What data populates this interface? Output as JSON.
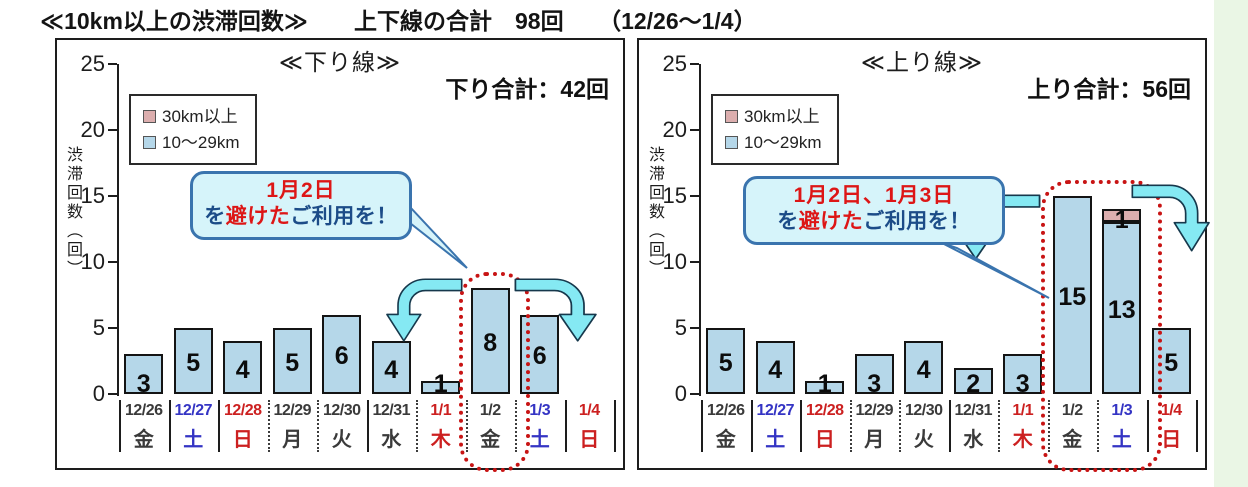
{
  "title": "≪10km以上の渋滞回数≫　　上下線の合計　98回　　（12/26～1/4）",
  "legend": {
    "items": [
      {
        "label": "30km以上",
        "color": "#dcaeae"
      },
      {
        "label": "10～29km",
        "color": "#b5d7e9"
      }
    ]
  },
  "y_axis": {
    "title": "渋滞回数（回）",
    "ticks": [
      25,
      20,
      15,
      10,
      5,
      0
    ]
  },
  "charts": [
    {
      "heading": "≪下り線≫",
      "total_label": "下り合計：42回",
      "callout": {
        "line1": "1月2日",
        "line2": [
          {
            "text": "を",
            "red": false
          },
          {
            "text": "避けた",
            "red": true
          },
          {
            "text": "ご利用を！",
            "red": false
          }
        ]
      },
      "highlight_days": [
        "1/2"
      ],
      "days": [
        {
          "date": "12/26",
          "weekday": "金",
          "color": "#3a3a3a",
          "sep": "solid"
        },
        {
          "date": "12/27",
          "weekday": "土",
          "color": "#3434c4",
          "sep": "solid"
        },
        {
          "date": "12/28",
          "weekday": "日",
          "color": "#cc2020",
          "sep": "solid"
        },
        {
          "date": "12/29",
          "weekday": "月",
          "color": "#3a3a3a",
          "sep": "dotted"
        },
        {
          "date": "12/30",
          "weekday": "火",
          "color": "#3a3a3a",
          "sep": "dotted"
        },
        {
          "date": "12/31",
          "weekday": "水",
          "color": "#3a3a3a",
          "sep": "solid"
        },
        {
          "date": "1/1",
          "weekday": "木",
          "color": "#cc2020",
          "sep": "dotted"
        },
        {
          "date": "1/2",
          "weekday": "金",
          "color": "#3a3a3a",
          "sep": "dotted"
        },
        {
          "date": "1/3",
          "weekday": "土",
          "color": "#3434c4",
          "sep": "dotted"
        },
        {
          "date": "1/4",
          "weekday": "日",
          "color": "#cc2020",
          "sep": "solid"
        }
      ]
    },
    {
      "heading": "≪上り線≫",
      "total_label": "上り合計：56回",
      "callout": {
        "line1": "1月2日、1月3日",
        "line2": [
          {
            "text": "を",
            "red": false
          },
          {
            "text": "避けた",
            "red": true
          },
          {
            "text": "ご利用を！",
            "red": false
          }
        ]
      },
      "highlight_days": [
        "1/2",
        "1/3"
      ],
      "days": [
        {
          "date": "12/26",
          "weekday": "金",
          "color": "#3a3a3a",
          "sep": "solid"
        },
        {
          "date": "12/27",
          "weekday": "土",
          "color": "#3434c4",
          "sep": "solid"
        },
        {
          "date": "12/28",
          "weekday": "日",
          "color": "#cc2020",
          "sep": "solid"
        },
        {
          "date": "12/29",
          "weekday": "月",
          "color": "#3a3a3a",
          "sep": "dotted"
        },
        {
          "date": "12/30",
          "weekday": "火",
          "color": "#3a3a3a",
          "sep": "dotted"
        },
        {
          "date": "12/31",
          "weekday": "水",
          "color": "#3a3a3a",
          "sep": "solid"
        },
        {
          "date": "1/1",
          "weekday": "木",
          "color": "#cc2020",
          "sep": "dotted"
        },
        {
          "date": "1/2",
          "weekday": "金",
          "color": "#3a3a3a",
          "sep": "dotted"
        },
        {
          "date": "1/3",
          "weekday": "土",
          "color": "#3434c4",
          "sep": "dotted"
        },
        {
          "date": "1/4",
          "weekday": "日",
          "color": "#cc2020",
          "sep": "solid"
        }
      ]
    }
  ],
  "chart_data": [
    {
      "type": "bar",
      "stacked": true,
      "title": "≪下り線≫",
      "subtitle": "下り合計：42回",
      "categories": [
        "12/26 金",
        "12/27 土",
        "12/28 日",
        "12/29 月",
        "12/30 火",
        "12/31 水",
        "1/1 木",
        "1/2 金",
        "1/3 土",
        "1/4 日"
      ],
      "series": [
        {
          "name": "10～29km",
          "color": "#b5d7e9",
          "values": [
            3,
            5,
            4,
            5,
            6,
            4,
            1,
            8,
            6,
            0
          ]
        },
        {
          "name": "30km以上",
          "color": "#dcaeae",
          "values": [
            0,
            0,
            0,
            0,
            0,
            0,
            0,
            0,
            0,
            0
          ]
        }
      ],
      "ylabel": "渋滞回数（回）",
      "ylim": [
        0,
        25
      ],
      "y_ticks": [
        0,
        5,
        10,
        15,
        20,
        25
      ],
      "legend_position": "upper-left",
      "grid": false,
      "annotation": "1月2日を避けたご利用を！",
      "highlighted_categories": [
        "1/2 金"
      ]
    },
    {
      "type": "bar",
      "stacked": true,
      "title": "≪上り線≫",
      "subtitle": "上り合計：56回",
      "categories": [
        "12/26 金",
        "12/27 土",
        "12/28 日",
        "12/29 月",
        "12/30 火",
        "12/31 水",
        "1/1 木",
        "1/2 金",
        "1/3 土",
        "1/4 日"
      ],
      "series": [
        {
          "name": "10～29km",
          "color": "#b5d7e9",
          "values": [
            5,
            4,
            1,
            3,
            4,
            2,
            3,
            15,
            13,
            5
          ]
        },
        {
          "name": "30km以上",
          "color": "#dcaeae",
          "values": [
            0,
            0,
            0,
            0,
            0,
            0,
            0,
            0,
            1,
            0
          ]
        }
      ],
      "ylabel": "渋滞回数（回）",
      "ylim": [
        0,
        25
      ],
      "y_ticks": [
        0,
        5,
        10,
        15,
        20,
        25
      ],
      "legend_position": "upper-left",
      "grid": false,
      "annotation": "1月2日、1月3日を避けたご利用を！",
      "highlighted_categories": [
        "1/2 金",
        "1/3 土"
      ]
    }
  ]
}
